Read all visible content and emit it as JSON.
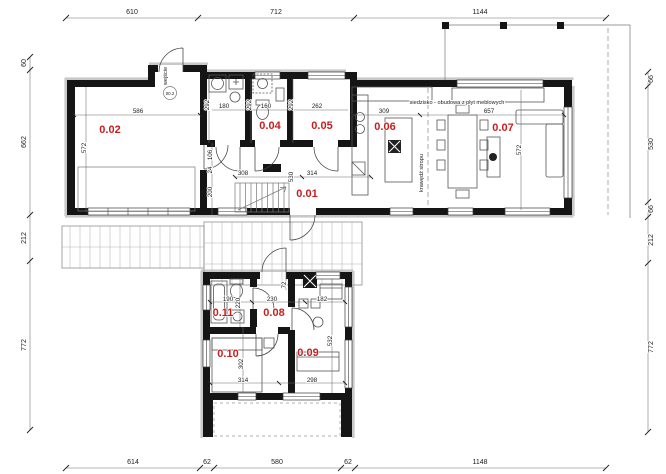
{
  "drawing": {
    "kind": "architectural-floor-plan",
    "language": "pl"
  },
  "colors": {
    "wall": "#151515",
    "room_label": "#c81e1e",
    "dimension_text": "#1c1c1c",
    "shadow": "#c9c9c9",
    "background": "#ffffff"
  },
  "room_labels": [
    {
      "id": "0.01",
      "x": 307,
      "y": 197
    },
    {
      "id": "0.02",
      "x": 110,
      "y": 133
    },
    {
      "id": "0.04",
      "x": 270,
      "y": 129
    },
    {
      "id": "0.05",
      "x": 322,
      "y": 129
    },
    {
      "id": "0.06",
      "x": 385,
      "y": 130
    },
    {
      "id": "0.07",
      "x": 503,
      "y": 131
    },
    {
      "id": "0.08",
      "x": 274,
      "y": 316
    },
    {
      "id": "0.09",
      "x": 308,
      "y": 356
    },
    {
      "id": "0.10",
      "x": 228,
      "y": 357
    },
    {
      "id": "0.11",
      "x": 223,
      "y": 316
    }
  ],
  "outer_dimensions": {
    "top": [
      {
        "text": "610",
        "x": 132,
        "y": 14
      },
      {
        "text": "712",
        "x": 276,
        "y": 14
      },
      {
        "text": "1144",
        "x": 480,
        "y": 14
      }
    ],
    "bottom": [
      {
        "text": "614",
        "x": 133,
        "y": 464
      },
      {
        "text": "62",
        "x": 207,
        "y": 464
      },
      {
        "text": "580",
        "x": 277,
        "y": 464
      },
      {
        "text": "62",
        "x": 348,
        "y": 464
      },
      {
        "text": "1148",
        "x": 480,
        "y": 464
      }
    ],
    "left": [
      {
        "text": "60",
        "x": 26,
        "y": 63,
        "rot": true
      },
      {
        "text": "662",
        "x": 26,
        "y": 142,
        "rot": true
      },
      {
        "text": "212",
        "x": 26,
        "y": 238,
        "rot": true
      },
      {
        "text": "772",
        "x": 26,
        "y": 345,
        "rot": true
      }
    ],
    "right": [
      {
        "text": "66",
        "x": 653,
        "y": 79,
        "rot": true
      },
      {
        "text": "530",
        "x": 653,
        "y": 144,
        "rot": true
      },
      {
        "text": "66",
        "x": 653,
        "y": 209,
        "rot": true
      },
      {
        "text": "212",
        "x": 653,
        "y": 240,
        "rot": true
      },
      {
        "text": "772",
        "x": 653,
        "y": 347,
        "rot": true
      }
    ]
  },
  "interior_dimensions": [
    {
      "text": "586",
      "x": 138,
      "y": 113
    },
    {
      "text": "572",
      "x": 86,
      "y": 148,
      "rot": true
    },
    {
      "text": "180",
      "x": 224,
      "y": 108
    },
    {
      "text": "292",
      "x": 209,
      "y": 105,
      "rot": true
    },
    {
      "text": "160",
      "x": 266,
      "y": 108
    },
    {
      "text": "292",
      "x": 251,
      "y": 105,
      "rot": true
    },
    {
      "text": "262",
      "x": 317,
      "y": 108
    },
    {
      "text": "292",
      "x": 293,
      "y": 105,
      "rot": true
    },
    {
      "text": "106",
      "x": 212,
      "y": 155,
      "rot": true
    },
    {
      "text": "24",
      "x": 212,
      "y": 170,
      "rot": true
    },
    {
      "text": "200",
      "x": 212,
      "y": 192,
      "rot": true
    },
    {
      "text": "308",
      "x": 243,
      "y": 175
    },
    {
      "text": "530",
      "x": 293,
      "y": 177,
      "rot": true
    },
    {
      "text": "314",
      "x": 312,
      "y": 175
    },
    {
      "text": "309",
      "x": 384,
      "y": 113
    },
    {
      "text": "657",
      "x": 489,
      "y": 113
    },
    {
      "text": "572",
      "x": 521,
      "y": 150,
      "rot": true
    },
    {
      "text": "190",
      "x": 228,
      "y": 301
    },
    {
      "text": "220",
      "x": 240,
      "y": 303,
      "rot": true
    },
    {
      "text": "230",
      "x": 272,
      "y": 301
    },
    {
      "text": "72",
      "x": 286,
      "y": 285,
      "rot": true
    },
    {
      "text": "182",
      "x": 322,
      "y": 301
    },
    {
      "text": "532",
      "x": 332,
      "y": 341,
      "rot": true
    },
    {
      "text": "302",
      "x": 243,
      "y": 364,
      "rot": true
    },
    {
      "text": "314",
      "x": 243,
      "y": 382
    },
    {
      "text": "298",
      "x": 312,
      "y": 382
    }
  ],
  "annotations": [
    {
      "text": "siedzisko - obudowa z płyt meblowych",
      "x": 457,
      "y": 104
    },
    {
      "text": "krawędź stropu",
      "x": 423,
      "y": 173,
      "rot": true
    },
    {
      "text": "wejście",
      "x": 167,
      "y": 76,
      "rot": true
    },
    {
      "text": "00.2",
      "x": 170,
      "y": 95,
      "tiny": true
    }
  ]
}
